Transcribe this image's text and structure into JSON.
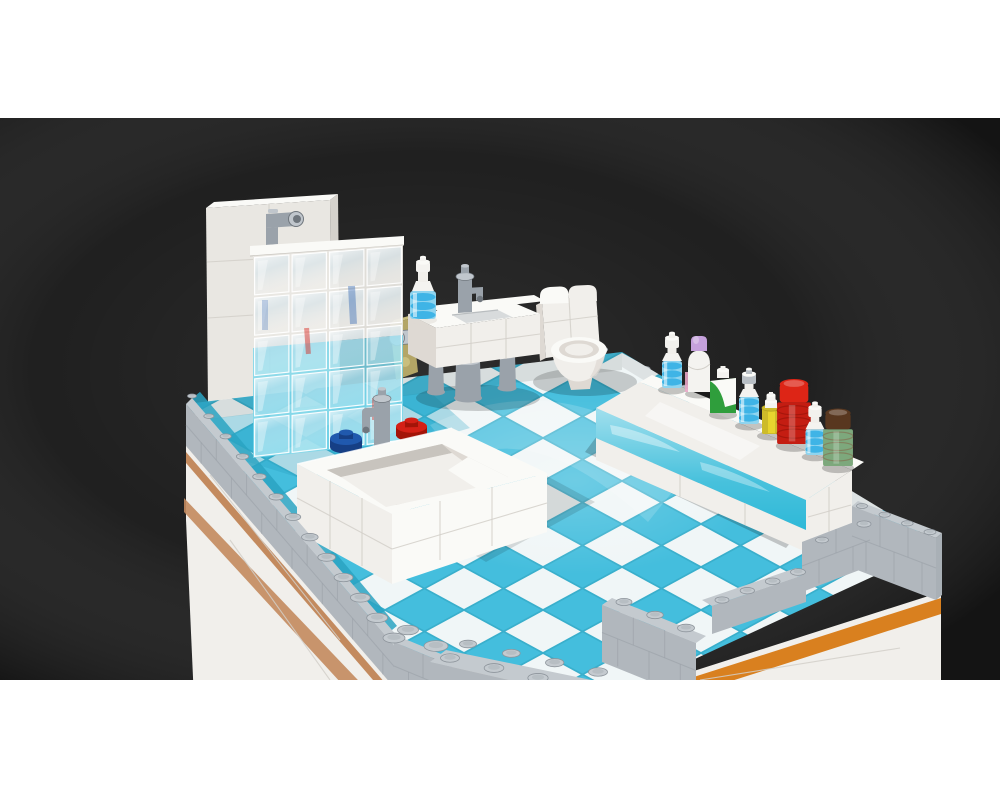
{
  "page": {
    "background": "#ffffff"
  },
  "render_image": {
    "description": "3D render of a LEGO bathroom interior model (MOC) viewed from above on a dark studio backdrop, letterboxed on a white page",
    "background": "#1b1b1b",
    "objects": [
      {
        "name": "backdrop",
        "label": "Dark studio backdrop"
      },
      {
        "name": "base-module",
        "label": "White modular base with orange and nougat stripes"
      },
      {
        "name": "perimeter-wall",
        "label": "Light gray brick perimeter wall with studs"
      },
      {
        "name": "tile-floor",
        "label": "Azure and white checkerboard tile floor"
      },
      {
        "name": "shower-wall",
        "label": "White shower wall and tower with gray shower pipe"
      },
      {
        "name": "glass-screen",
        "label": "Transparent glass block shower screen"
      },
      {
        "name": "bathtub",
        "label": "White brick bathtub with blue and red taps and gray faucet"
      },
      {
        "name": "sink",
        "label": "White sink on gray legs with faucet"
      },
      {
        "name": "soap-bottle",
        "label": "White soap dispenser bottle with transparent blue ribs"
      },
      {
        "name": "hamper",
        "label": "Olive hamper with gray handle beside the sink"
      },
      {
        "name": "toilet",
        "label": "White toilet with curved cistern and round bowl"
      },
      {
        "name": "vanity",
        "label": "Vanity counter with azure drawer front"
      },
      {
        "name": "toiletries",
        "label": "Row of toiletry bottles and jars on the vanity"
      }
    ],
    "bottles": [
      {
        "name": "dispenser-1",
        "type": "dispenser",
        "cap": "#f2f1ed"
      },
      {
        "name": "lotion",
        "type": "lotion",
        "cap": "#c5a1dc"
      },
      {
        "name": "shampoo",
        "type": "shampoo",
        "body": "#2f9e3c"
      },
      {
        "name": "dispenser-2",
        "type": "dispenser",
        "cap": "#b9bfc5"
      },
      {
        "name": "shower-gel",
        "type": "cylinder",
        "body": "#e9d52e"
      },
      {
        "name": "red-jar",
        "type": "jar",
        "cap": "#dd2516",
        "body": "#c41d12",
        "scale": 1.3
      },
      {
        "name": "dispenser-3",
        "type": "dispenser",
        "cap": "#f2f1ed",
        "scale": 0.95
      },
      {
        "name": "green-jar",
        "type": "jar",
        "cap": "#58371f",
        "body": "#7da87c",
        "scale": 1.15
      }
    ],
    "colors": {
      "pageBg": "#ffffff",
      "renderBg": "#1b1b1b",
      "shadow": "#000000",
      "white": "#f4f3f0",
      "brickWhite": "#f1efeb",
      "brickBright": "#fafaf7",
      "brickShade": "#ded9d3",
      "brickDark": "#c8c4be",
      "seam": "#d2cfc9",
      "towerFace": "#e9e7e2",
      "towerSide": "#d5d2cc",
      "gray": "#a9b0b6",
      "grayLight": "#c4cacf",
      "grayFace": "#b1b7bd",
      "grayDark": "#899097",
      "studEdge": "#8e959c",
      "masonSeam": "#99a0a7",
      "azure": "#44bedd",
      "azureLight": "#7ed7ea",
      "azureDeep": "#2aa3c2",
      "tileWhite": "#f0f6f7",
      "tileGap": "#39afcc",
      "counterAzure": "#2fb9d8",
      "orange": "#d9801f",
      "nougat": "#c38a5e",
      "tapBlue": "#2059ae",
      "tapBlueDark": "#163f85",
      "tapRed": "#d42016",
      "tapRedDark": "#a31408",
      "metal": "#9aa2aa",
      "metalLight": "#c0c6cc",
      "metalDark": "#6f767d",
      "transBlue": "#8fd4ef",
      "transBlueDeep": "#3fb4e6",
      "olive": "#b3a566",
      "oliveLight": "#c9be7d",
      "lavender": "#c5a1dc",
      "pink": "#e8a6c6",
      "green": "#2f9e3c",
      "yellow": "#e9d52e",
      "yellowDeep": "#cdbb2a",
      "transRed": "#c41d12",
      "transRedDark": "#8e1008",
      "redCap": "#dd2516",
      "brown": "#58371f",
      "brownLight": "#6f4527",
      "sageGreen": "#7da87c",
      "glassHi": "#ffffff",
      "glassTint": "#cfe4f0"
    }
  }
}
